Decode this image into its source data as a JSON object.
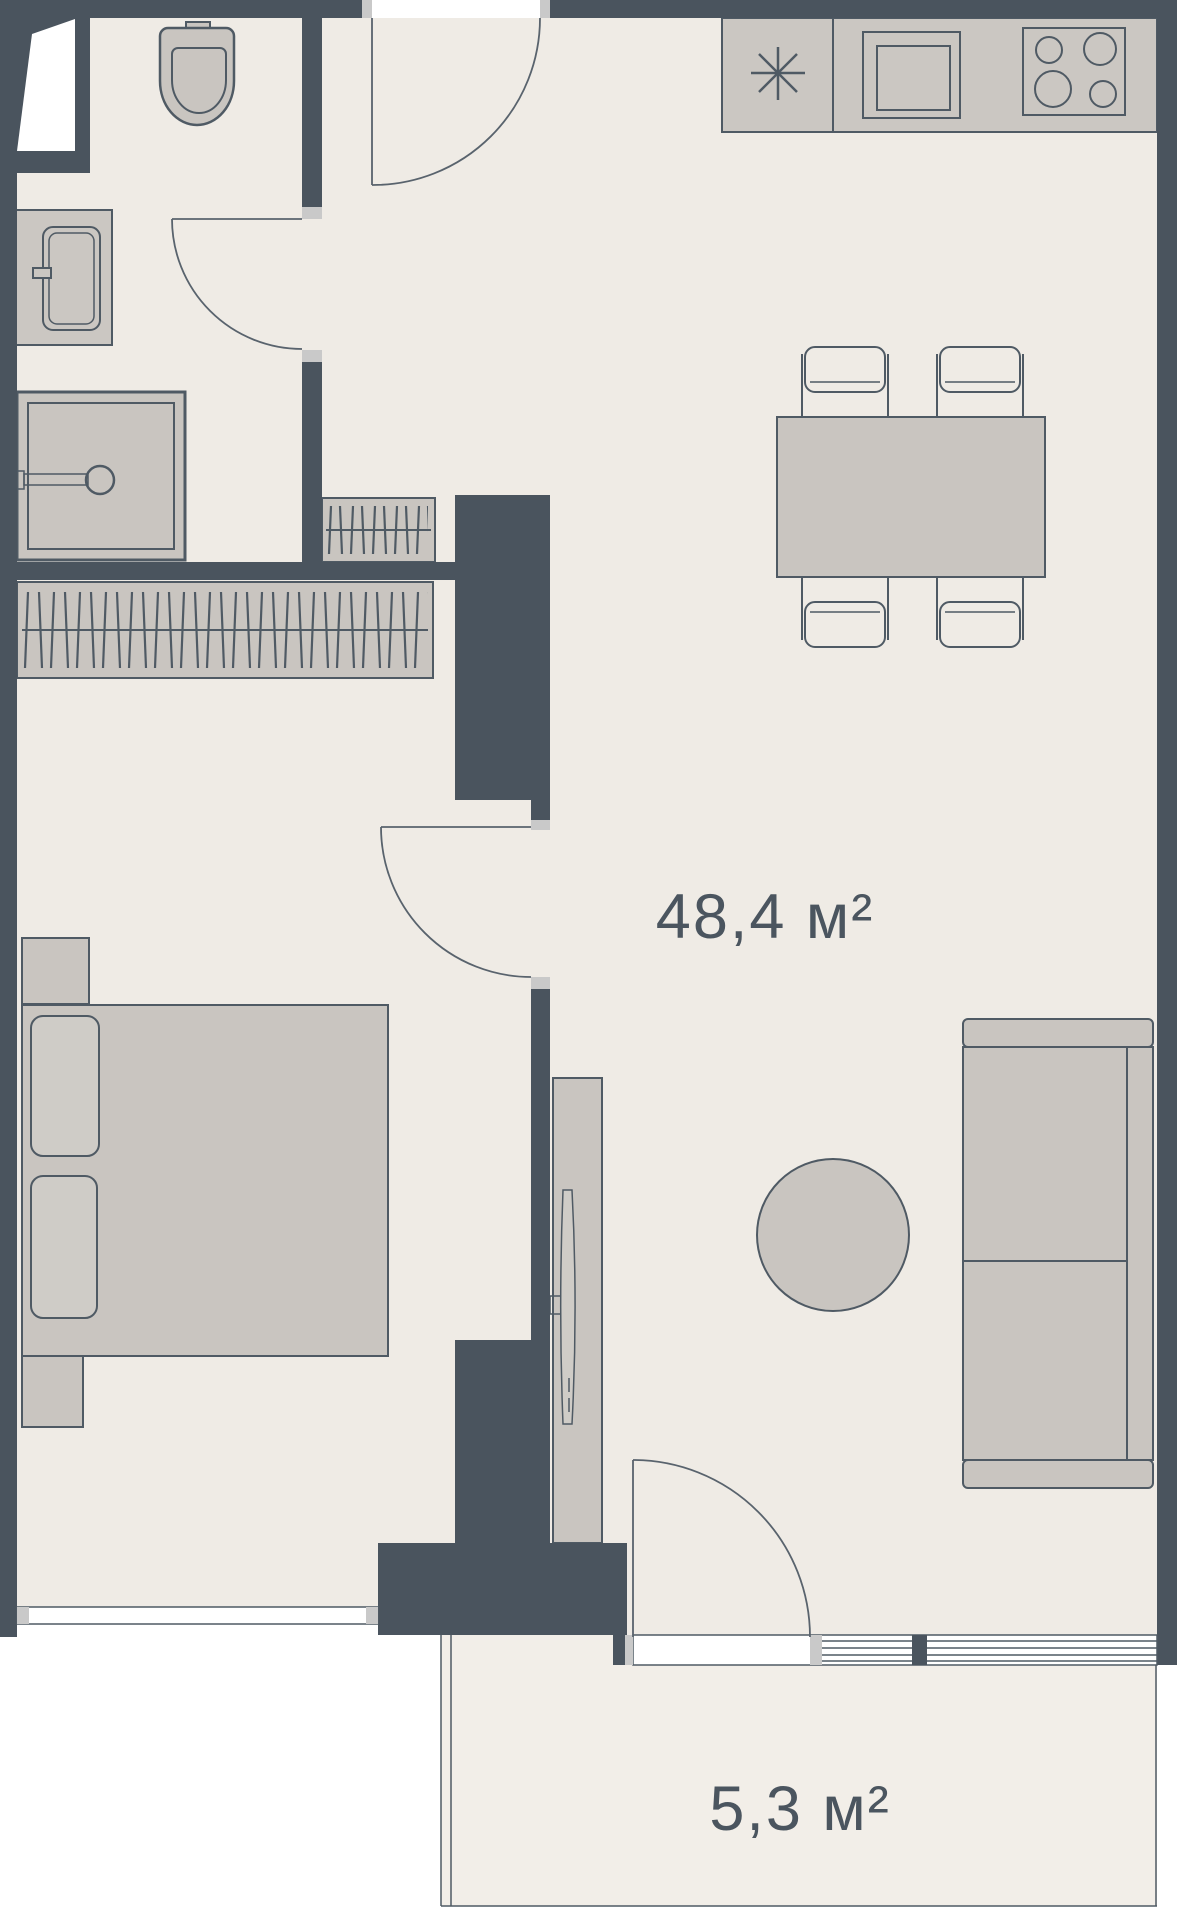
{
  "title": "apartment-floor-plan",
  "labels": {
    "main_area": "48,4 м²",
    "balcony_area": "5,3 м²"
  },
  "rooms": [
    {
      "name": "main-room",
      "area_label": "48,4 м²"
    },
    {
      "name": "balcony",
      "area_label": "5,3 м²"
    }
  ],
  "fixtures": [
    "toilet-icon",
    "washing-machine-icon",
    "shower-icon",
    "corner-window",
    "entry-door",
    "bathroom-door",
    "bedroom-door",
    "balcony-door",
    "wardrobe-hangers-small",
    "wardrobe-hangers-large",
    "kitchen-counter",
    "fridge-asterisk-symbol",
    "sink-icon",
    "stove-icon",
    "dining-table",
    "chair",
    "bed",
    "pillow",
    "nightstand",
    "tv-console",
    "tv-icon",
    "sofa",
    "coffee-table",
    "bedroom-window",
    "balcony-window-railing"
  ],
  "colors": {
    "wall": "#4a545e",
    "floor": "#efebe5",
    "floor-balcony": "#f2eee8",
    "furniture": "#c9c5c0",
    "furniture-light": "#cfccc7",
    "counter": "#cbc7c2",
    "jamb": "#c9c9c9",
    "line": "#4f5a64",
    "text": "#4b555f",
    "outside": "#ffffff"
  }
}
